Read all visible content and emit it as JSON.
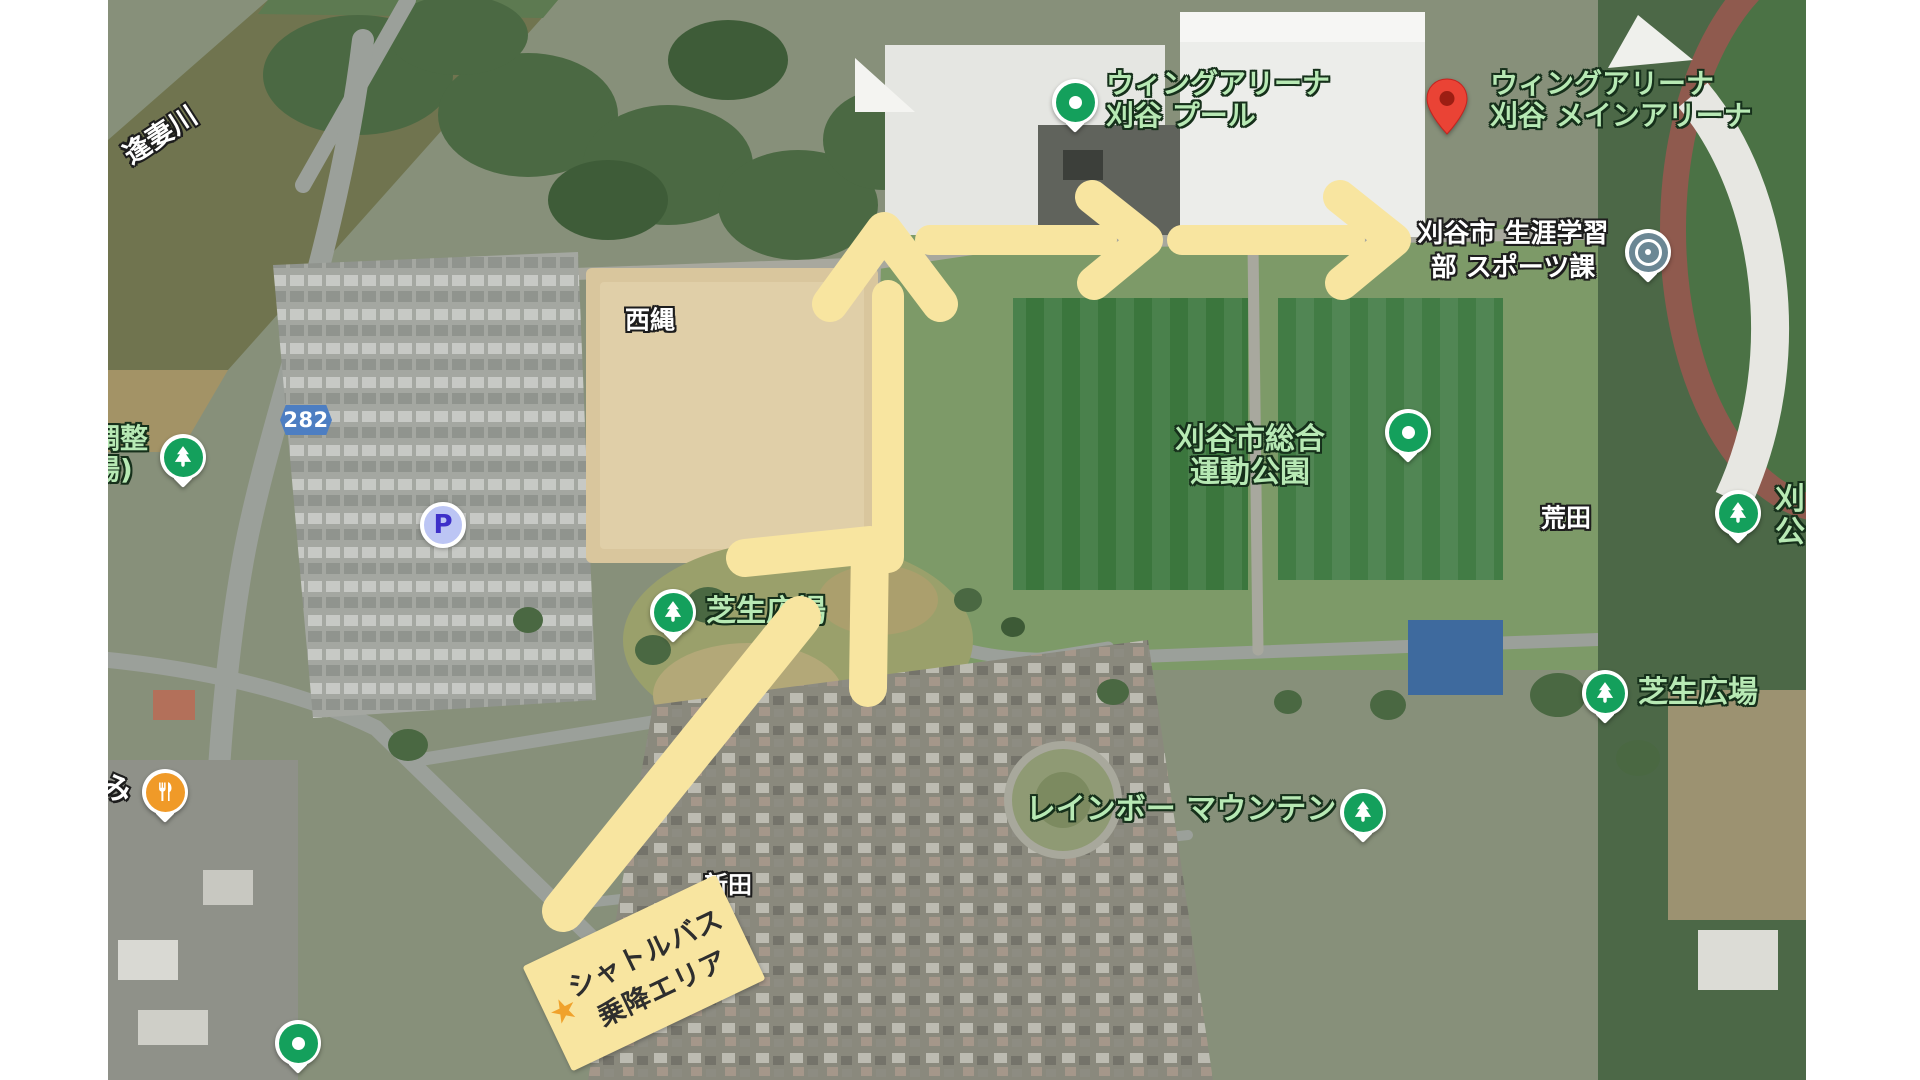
{
  "canvas": {
    "width": 1920,
    "height": 1080
  },
  "colors": {
    "route_yellow": "#F8E5A0",
    "label_green": "#B7E9B4",
    "pin_green": "#14A05C",
    "red_marker": "#EA4335",
    "red_marker_inner": "#9C1E13",
    "civic_slate": "#6B8794",
    "parking_circle_bg": "#BCC5F4",
    "parking_letter": "#3D2FC9",
    "restaurant_orange": "#F09A28",
    "road_badge_blue": "#4D7EC2",
    "star_orange": "#F0A22C"
  },
  "map": {
    "labels": {
      "river": "逢妻川",
      "nishinawa": "西縄",
      "arata": "荒田",
      "shinden": "新田",
      "mi": "み",
      "chousei_line1": "調整",
      "chousei_line2": "場)",
      "kariya_clip_line1": "刈",
      "kariya_clip_line2": "公"
    },
    "pois": {
      "pool": {
        "line1": "ウィングアリーナ",
        "line2": "刈谷 プール",
        "icon": "green-dot-pin"
      },
      "main_arena": {
        "line1": "ウィングアリーナ",
        "line2": "刈谷 メインアリーナ",
        "icon": "red-marker-pin"
      },
      "sports_division": {
        "line1": "刈谷市 生涯学習",
        "line2": "部 スポーツ課",
        "icon": "civic-target-pin"
      },
      "sports_park": {
        "line1": "刈谷市総合",
        "line2": "運動公園",
        "icon": "green-dot-pin"
      },
      "lawn_plaza_left": {
        "label": "芝生広場",
        "icon": "tree-pin"
      },
      "lawn_plaza_right": {
        "label": "芝生広場",
        "icon": "tree-pin"
      },
      "roadside_park": {
        "icon": "tree-pin"
      },
      "kariya_park_clipped": {
        "icon": "tree-pin"
      },
      "rainbow_mountain": {
        "label": "レインボー マウンテン",
        "icon": "tree-pin"
      },
      "parking": {
        "label": "P",
        "icon": "parking-circle"
      },
      "restaurant": {
        "icon": "restaurant-pin"
      },
      "south_poi": {
        "icon": "green-dot-pin"
      },
      "road_badge": {
        "number": "282"
      }
    },
    "route": {
      "shuttle_area": {
        "star": "★",
        "line1": "シャトルバス",
        "line2": "乗降エリア"
      },
      "arrow_color": "#F8E5A0",
      "arrows": [
        "diagonal-up-right",
        "up",
        "right",
        "right"
      ]
    }
  }
}
